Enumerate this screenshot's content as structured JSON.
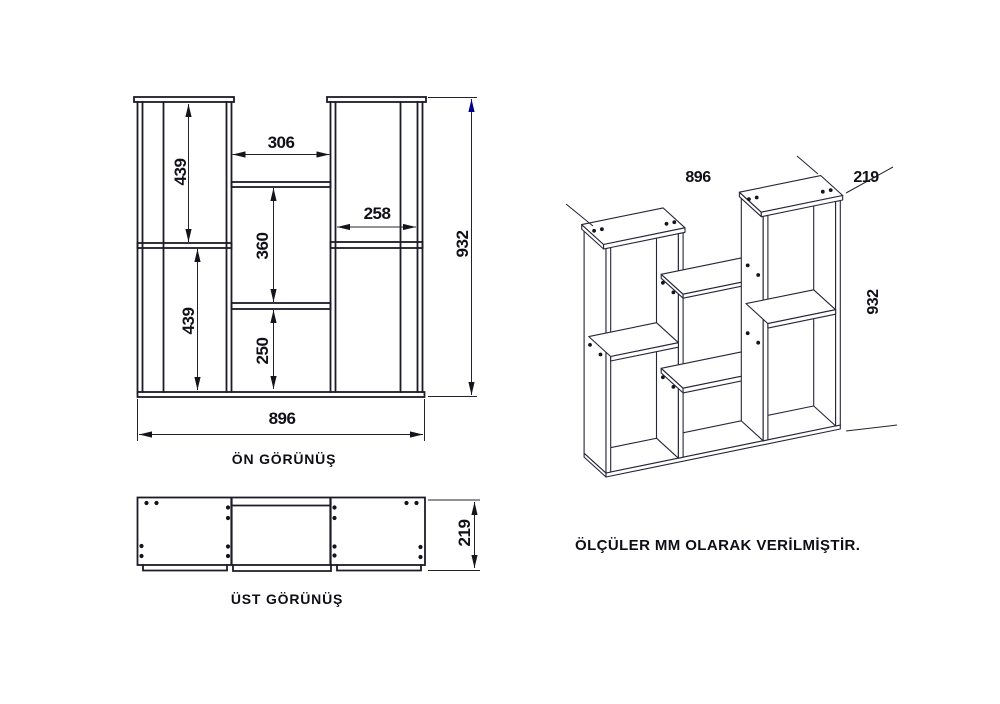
{
  "front_view": {
    "title": "ÖN GÖRÜNÜŞ",
    "dim_upper_left": "439",
    "dim_lower_left": "439",
    "dim_top_opening": "306",
    "dim_middle_upper": "360",
    "dim_middle_lower": "250",
    "dim_right_shelf": "258",
    "dim_height": "932",
    "dim_width": "896"
  },
  "top_view": {
    "title": "ÜST GÖRÜNÜŞ",
    "dim_depth": "219"
  },
  "iso_view": {
    "dim_width": "896",
    "dim_depth": "219",
    "dim_height": "932"
  },
  "note": "ÖLÇÜLER MM OLARAK VERİLMİŞTİR.",
  "colors": {
    "line": "#1c1c28",
    "dim_line": "#23232e",
    "accent_arrow": "#00008b",
    "background": "#ffffff"
  }
}
